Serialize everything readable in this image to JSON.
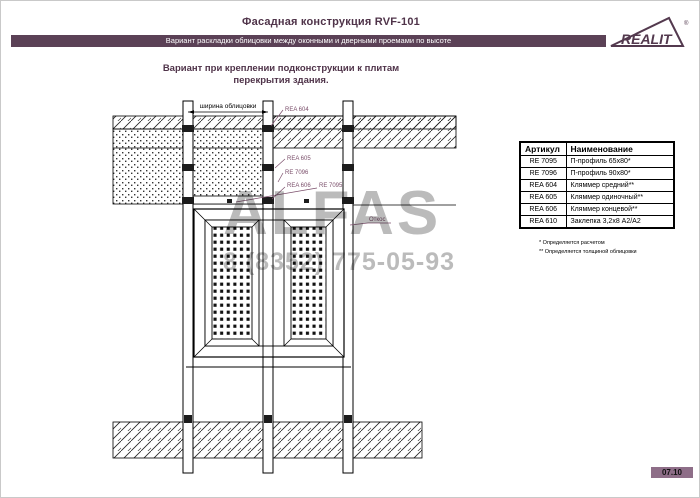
{
  "header": {
    "title": "Фасадная конструкция RVF-101",
    "subtitle_bar": "Вариант раскладки облицовки между оконными и дверными проемами по высоте",
    "logo_text": "REALIT",
    "logo_reg": "®"
  },
  "caption": {
    "line1": "Вариант при креплении подконструкции к плитам",
    "line2": "перекрытия здания."
  },
  "drawing": {
    "dim_width_label": "ширина облицовки",
    "labels": {
      "rea604": "REA 604",
      "rea605": "REA 605",
      "re7096": "RE 7096",
      "rea606": "REA 606",
      "re7095": "RE 7095",
      "otkos": "Откос"
    }
  },
  "parts_table": {
    "headers": [
      "Артикул",
      "Наименование"
    ],
    "rows": [
      [
        "RE 7095",
        "П-профиль 65x80*"
      ],
      [
        "RE 7096",
        "П-профиль 90x80*"
      ],
      [
        "REA 604",
        "Кляммер средний**"
      ],
      [
        "REA 605",
        "Кляммер одиночный**"
      ],
      [
        "REA 606",
        "Кляммер концевой**"
      ],
      [
        "REA 610",
        "Заклепка 3,2x8 А2/А2"
      ]
    ],
    "footnotes": [
      "* Определяется расчетом",
      "** Определяется толщиной облицовки"
    ]
  },
  "watermark": {
    "brand": "ALFAS",
    "phone": "8 (8352) 775-05-93"
  },
  "footer": {
    "page_code": "07.10"
  },
  "colors": {
    "accent": "#5b4156",
    "label": "#7b4f6b",
    "badge": "#8e6e88"
  }
}
